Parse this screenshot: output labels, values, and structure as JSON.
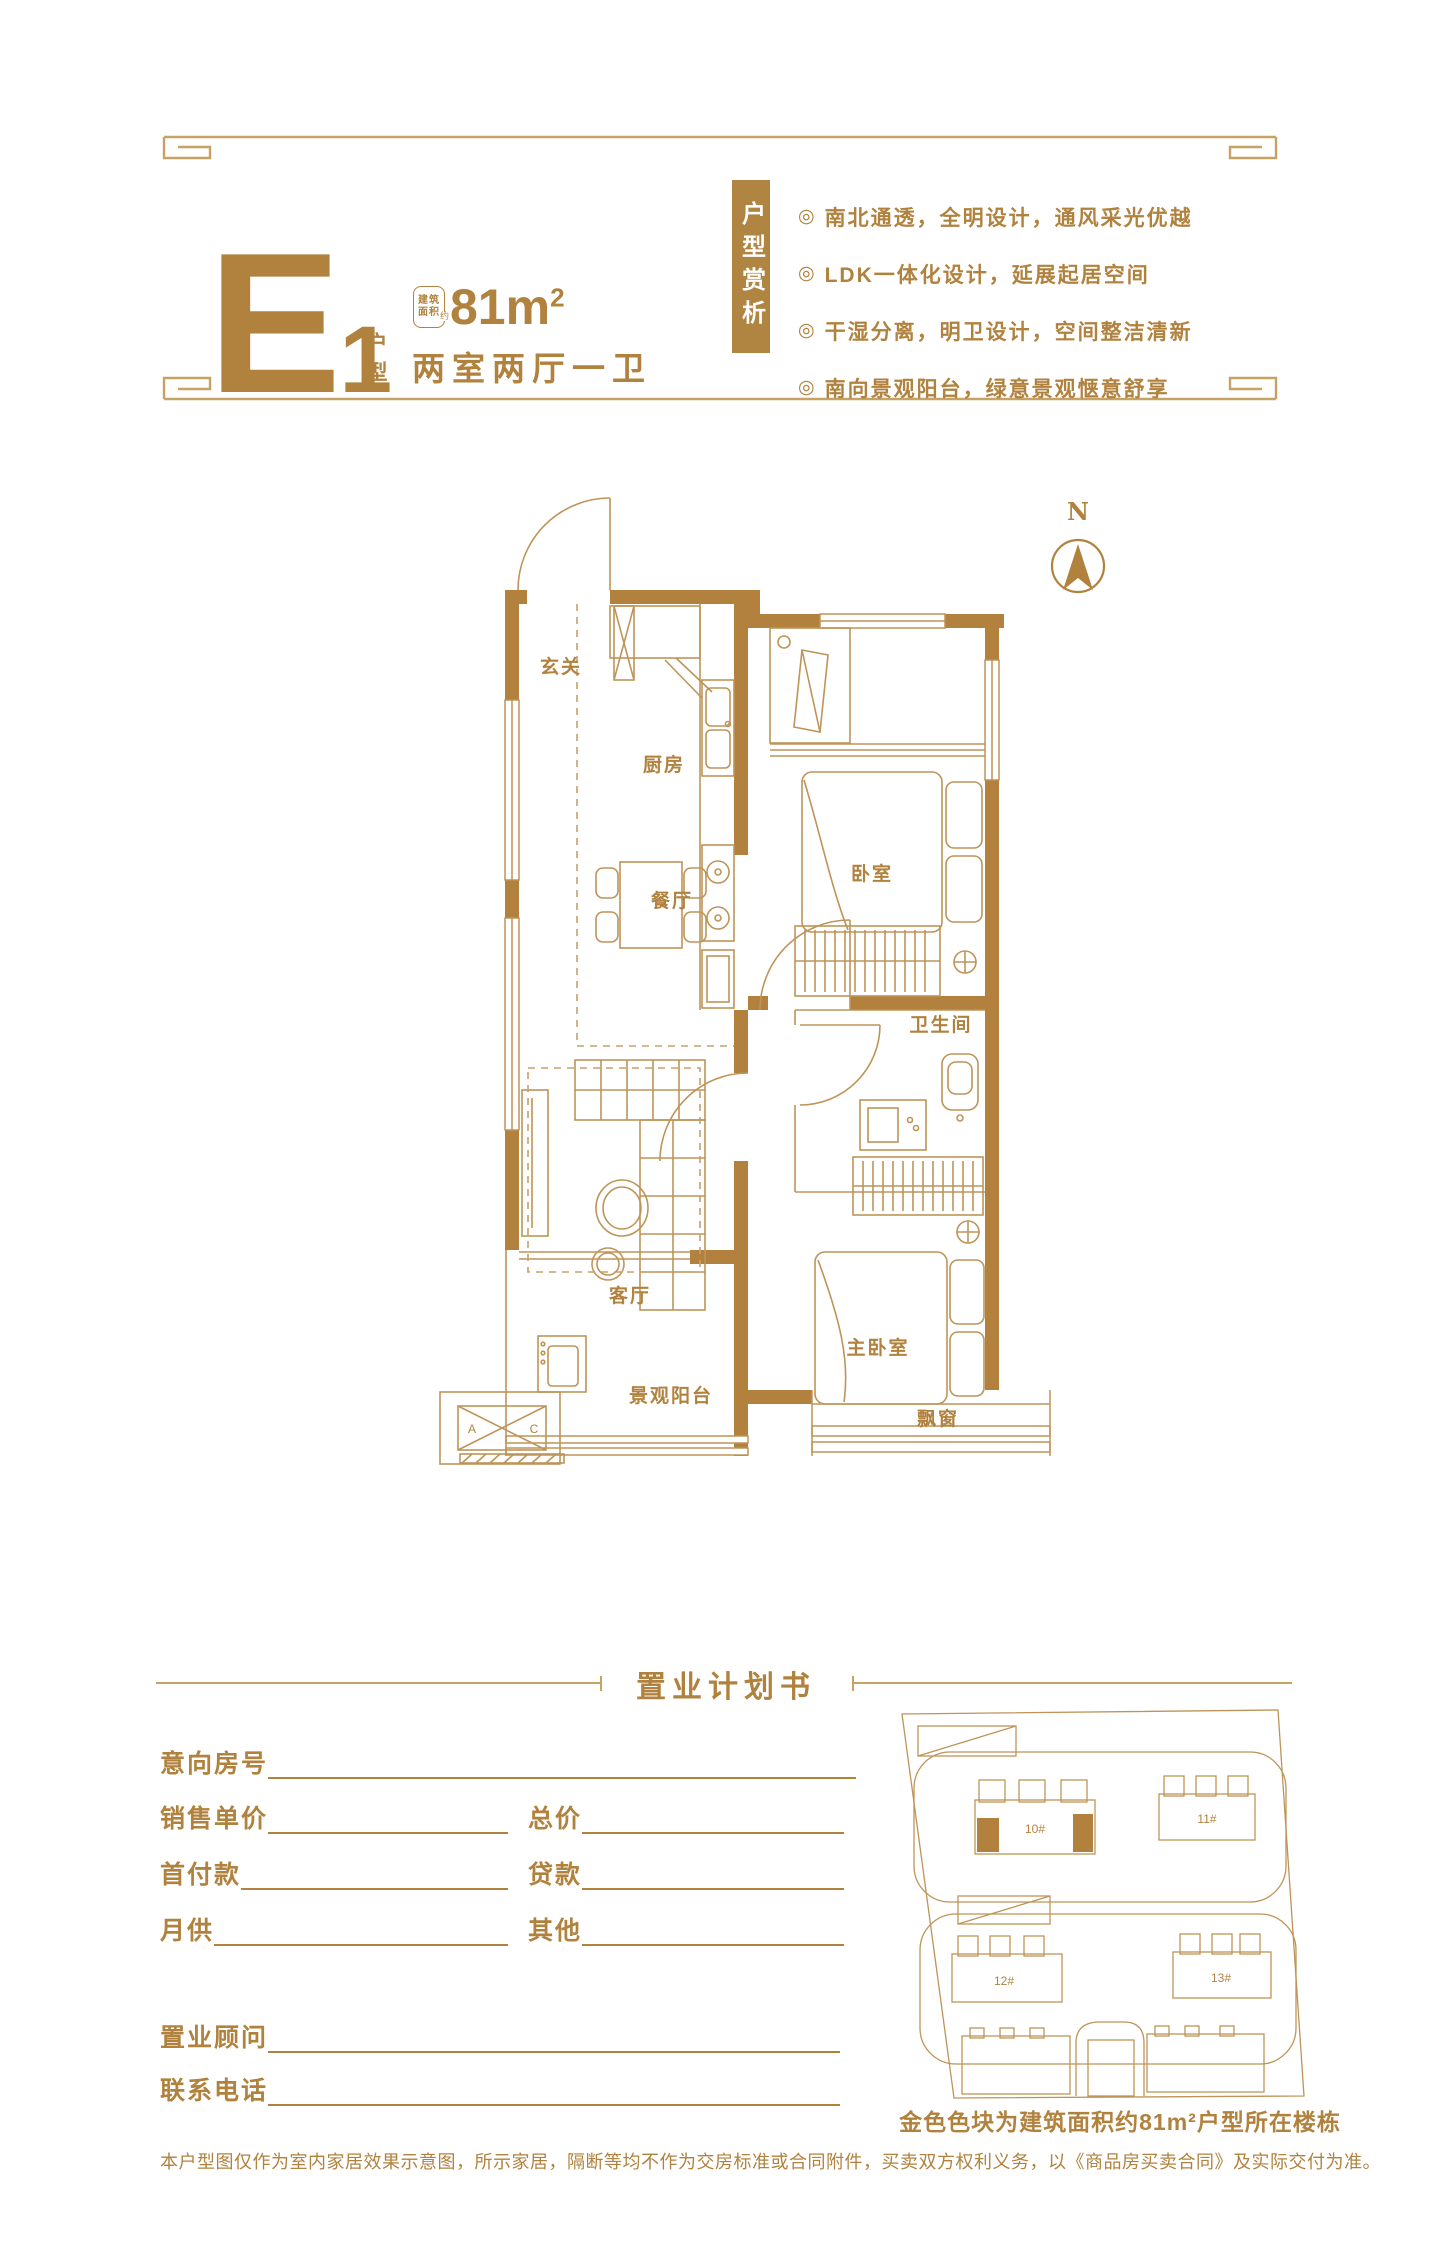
{
  "colors": {
    "accent": "#B1823E",
    "wall": "#B1813D",
    "thin_line": "#BE9458",
    "hairline": "#C8A265",
    "badge_bg": "#B08441"
  },
  "header": {
    "unit_code": "E",
    "unit_number": "1",
    "unit_type_label": "户型",
    "area_stamp_line1": "建筑",
    "area_stamp_line2": "面积",
    "area_stamp_approx": "约",
    "area_value": "81m",
    "area_sup": "2",
    "layout_desc": "两室两厅一卫",
    "badge": "户型赏析",
    "feature_marker": "◎",
    "features": [
      "南北通透，全明设计，通风采光优越",
      "LDK一体化设计，延展起居空间",
      "干湿分离，明卫设计，空间整洁清新",
      "南向景观阳台，绿意景观惬意舒享"
    ]
  },
  "floor_plan": {
    "north": "N",
    "rooms": {
      "entry": "玄关",
      "kitchen": "厨房",
      "bedroom": "卧室",
      "dining": "餐厅",
      "bath": "卫生间",
      "living": "客厅",
      "master": "主卧室",
      "balcony": "景观阳台",
      "bay": "飘窗"
    },
    "ac": {
      "a": "A",
      "c": "C"
    }
  },
  "plan_section": {
    "title": "置业计划书",
    "fields": {
      "room_no": "意向房号",
      "unit_price": "销售单价",
      "total_price": "总价",
      "down_payment": "首付款",
      "loan": "贷款",
      "monthly": "月供",
      "other": "其他",
      "consultant": "置业顾问",
      "phone": "联系电话"
    }
  },
  "site_plan": {
    "buildings": [
      "10#",
      "11#",
      "12#",
      "13#"
    ],
    "caption": "金色色块为建筑面积约81m²户型所在楼栋"
  },
  "footer": {
    "disclaimer": "本户型图仅作为室内家居效果示意图，所示家居，隔断等均不作为交房标准或合同附件，买卖双方权利义务，以《商品房买卖合同》及实际交付为准。"
  }
}
